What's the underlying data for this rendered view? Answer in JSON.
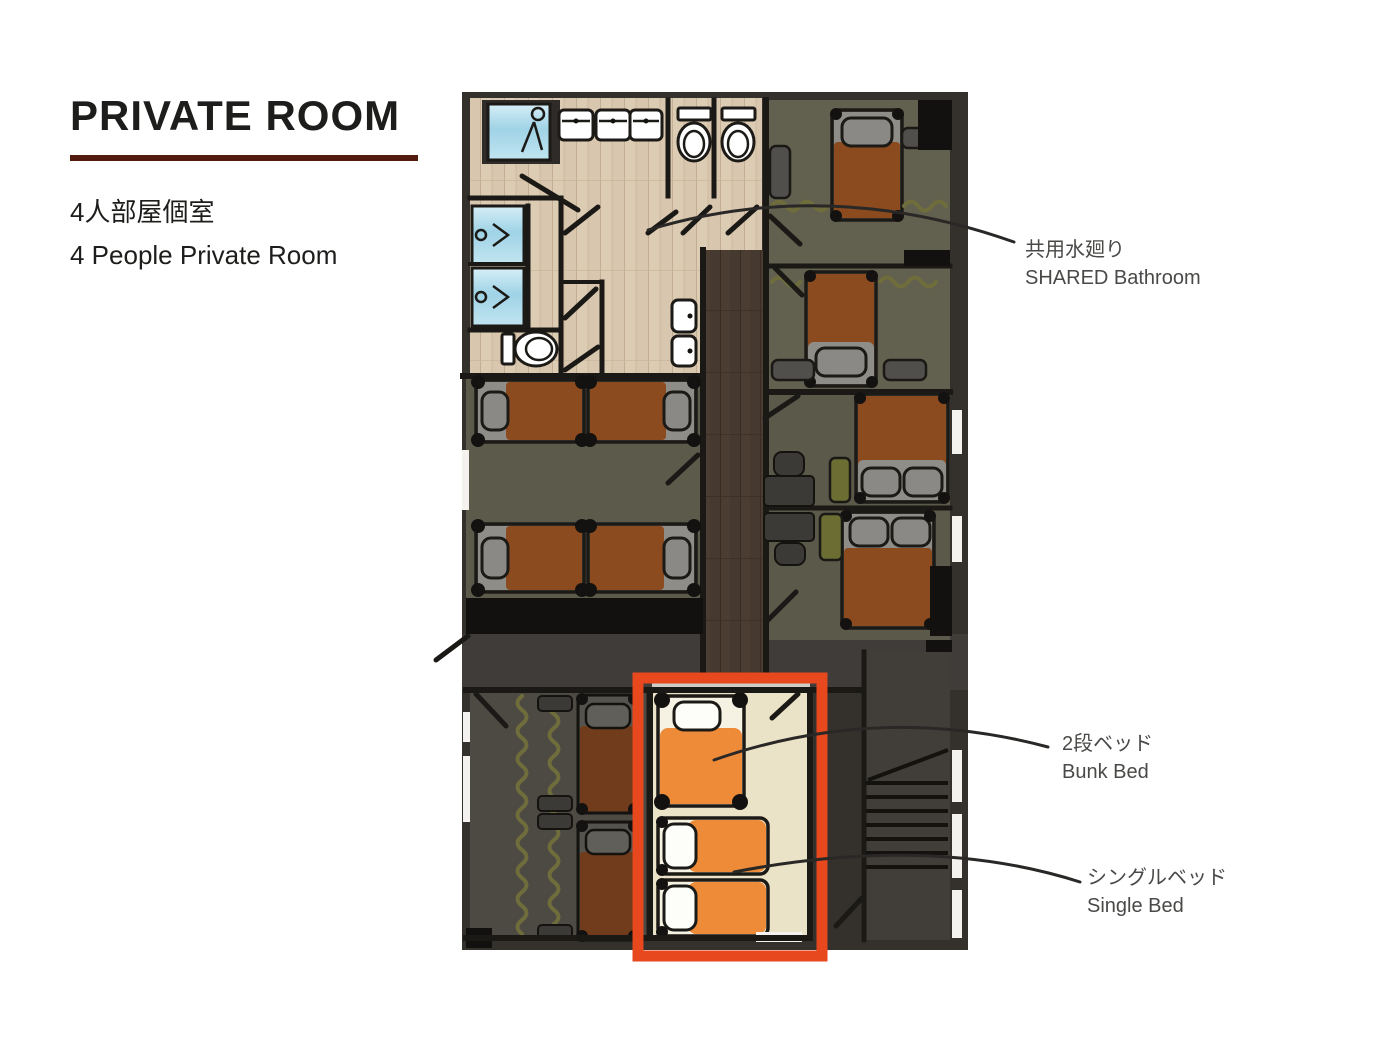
{
  "header": {
    "title": "PRIVATE ROOM",
    "subtitle_jp": "4人部屋個室",
    "subtitle_en": "4 People Private Room"
  },
  "annotations": [
    {
      "jp": "共用水廻り",
      "en": "SHARED Bathroom"
    },
    {
      "jp": "2段ベッド",
      "en": "Bunk Bed"
    },
    {
      "jp": "シングルベッド",
      "en": "Single Bed"
    }
  ],
  "floor_plan": {
    "highlighted_room": "4 People Private Room",
    "fixture_icons": [
      "shower-icon",
      "sink-icon",
      "toilet-icon",
      "washlet-icon",
      "bed",
      "bunk-bed",
      "single-bed",
      "table",
      "chair",
      "sofa",
      "nightstand",
      "stairs-icon",
      "door-swing",
      "window"
    ]
  },
  "colors": {
    "highlight_box": "#e8481d",
    "title_underline": "#531b10",
    "text_primary": "#1d1d1b",
    "text_annotation": "#4a4947",
    "wall_dark": "#34312d",
    "bathroom_floor": "#d9c6ae",
    "corridor_floor": "#46392f",
    "cream_floor": "#ebe3c7",
    "bed_orange": "#ee8b39",
    "shower_blue": "#9fd3e6"
  }
}
